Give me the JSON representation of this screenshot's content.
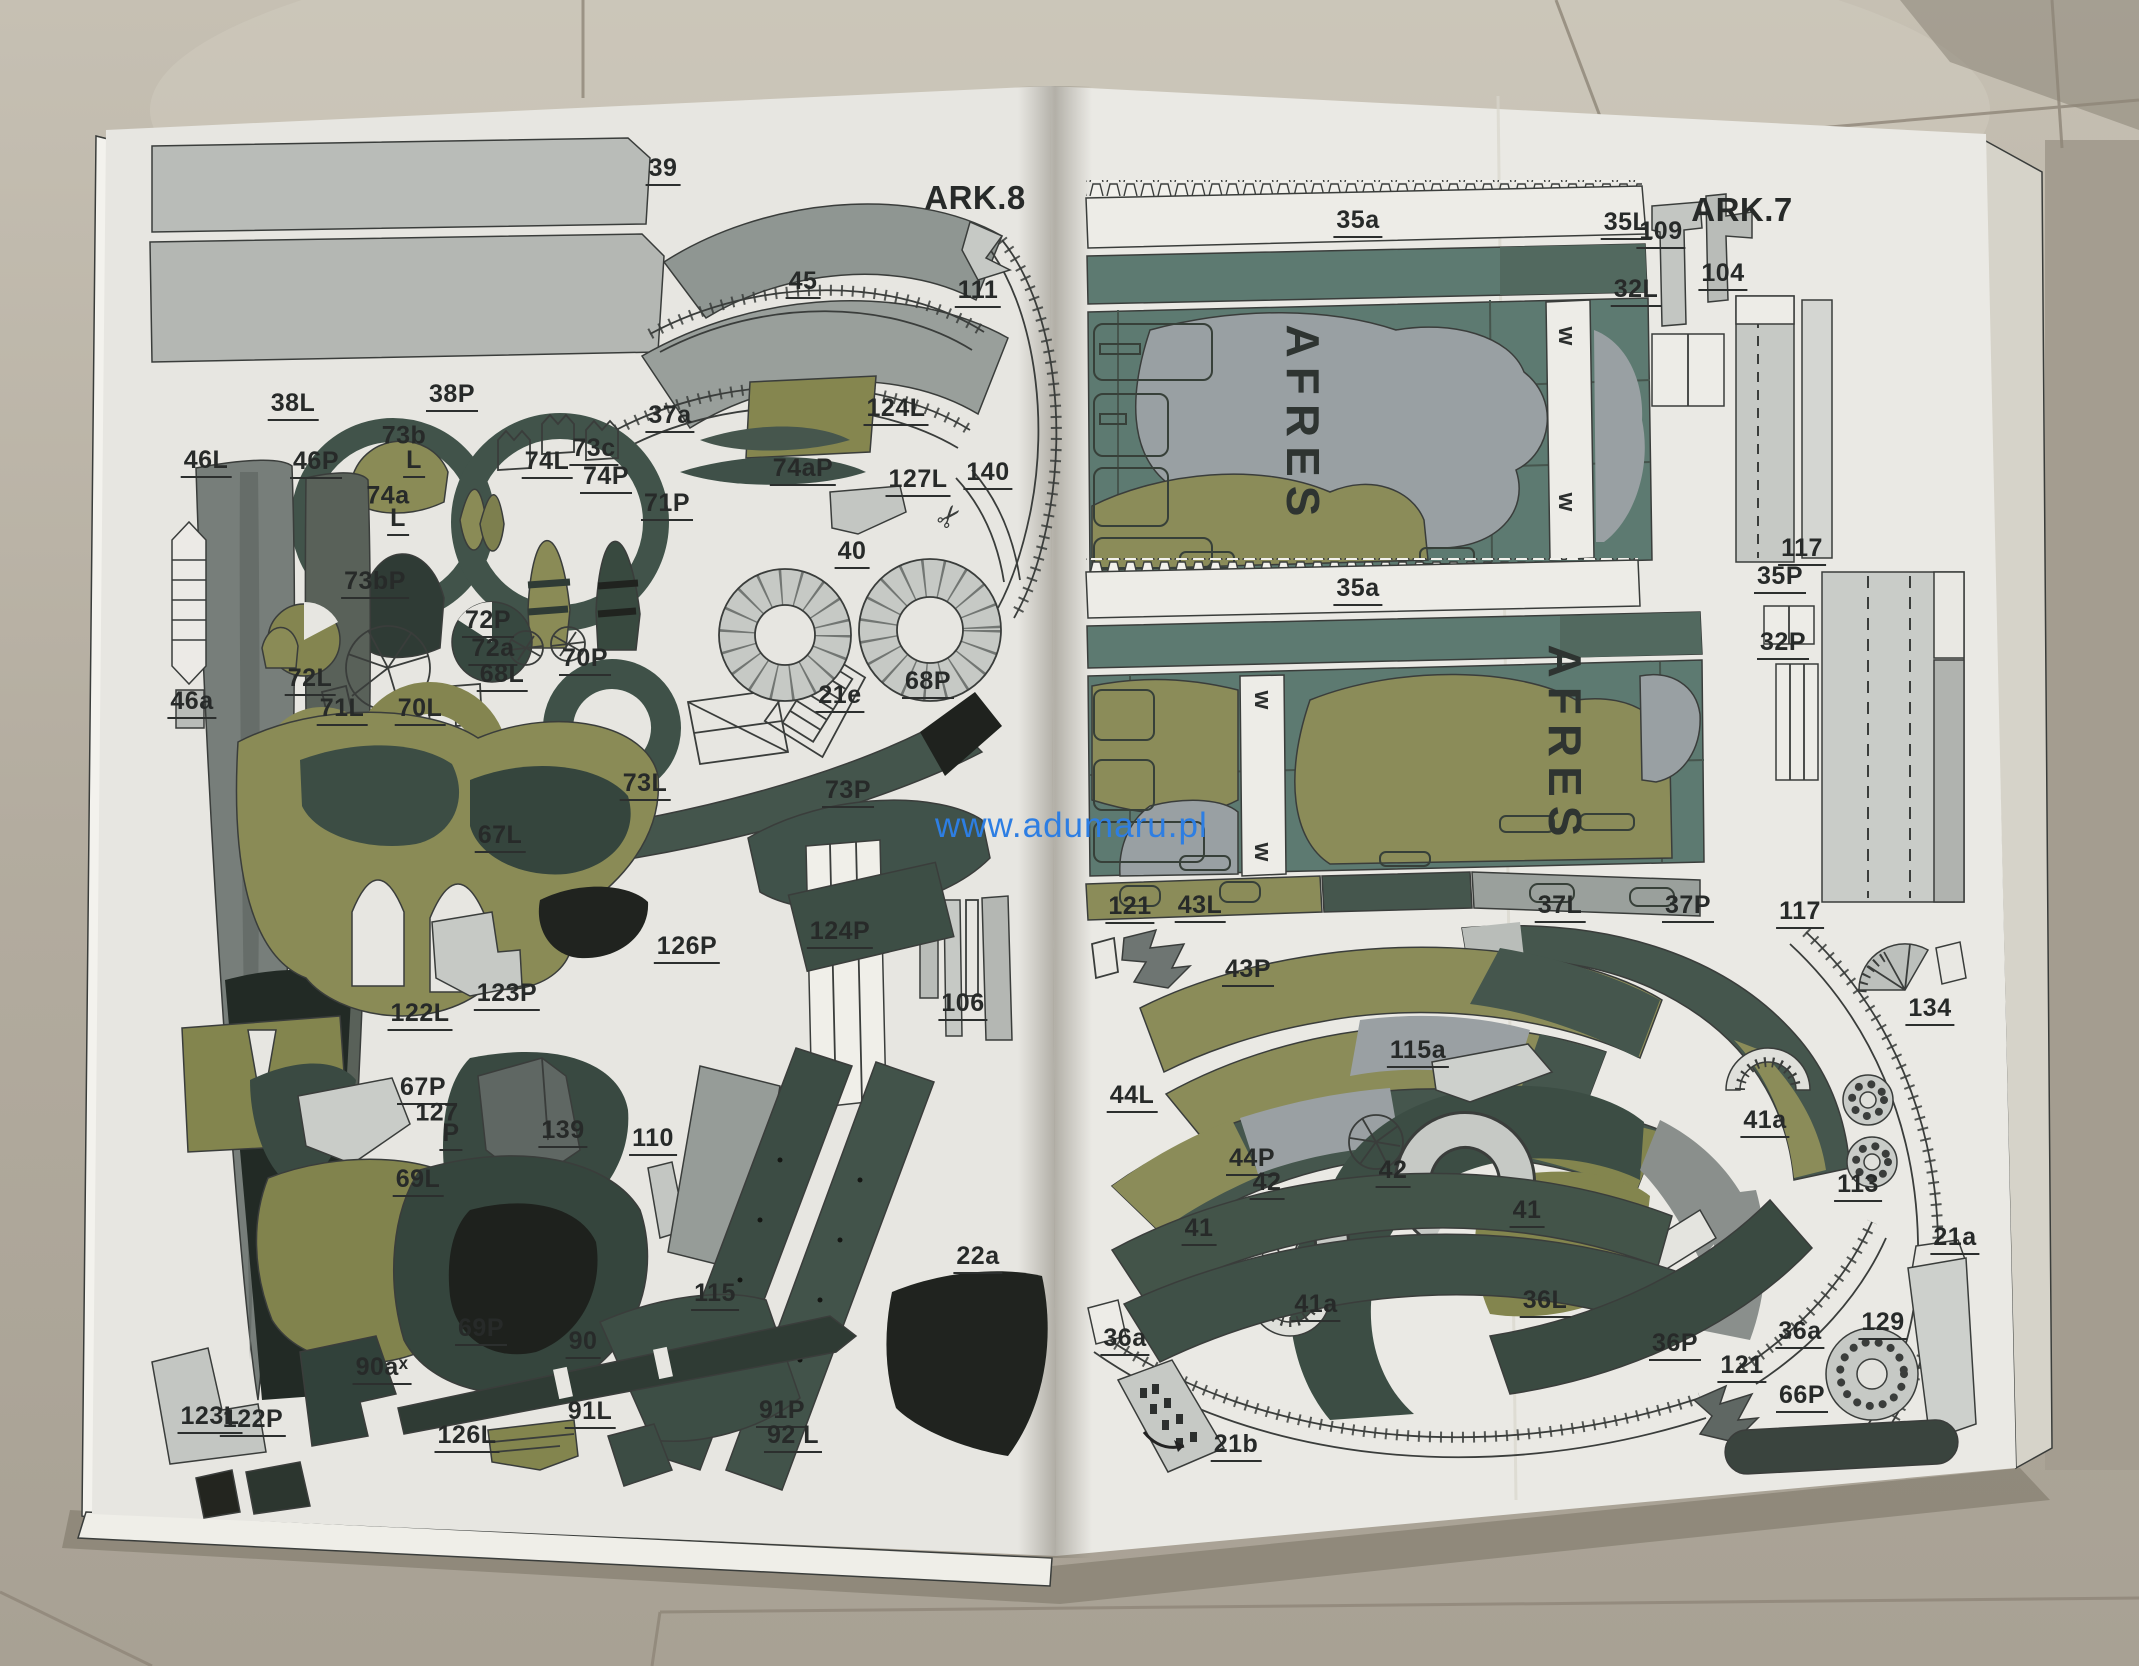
{
  "watermark": "www.adumaru.pl",
  "sheets": {
    "left": "ARK.8",
    "right": "ARK.7"
  },
  "panel_text": "AFRES",
  "w_marker": "w",
  "icons": {
    "scissors": "✂"
  },
  "left_labels": {
    "n39": "39",
    "n45": "45",
    "n111": "111",
    "n38L": "38L",
    "n38P": "38P",
    "n46L": "46L",
    "n46P": "46P",
    "n73b": "73b",
    "n73b_l": "L",
    "n74L": "74L",
    "n73c": "73c",
    "n74P": "74P",
    "n74a": "74a",
    "n74a_l": "L",
    "n73bP": "73bP",
    "n37a": "37a",
    "n74aP": "74aP",
    "n124L": "124L",
    "n127L": "127L",
    "n140": "140",
    "n71P": "71P",
    "n40": "40",
    "n72P": "72P",
    "n72a": "72a",
    "n70P": "70P",
    "n68L": "68L",
    "n21e": "21e",
    "n68P": "68P",
    "n72L": "72L",
    "n71L": "71L",
    "n70L": "70L",
    "n46a": "46a",
    "n73L": "73L",
    "n73P": "73P",
    "n67L": "67L",
    "n124P": "124P",
    "n126P": "126P",
    "n106": "106",
    "n122L": "122L",
    "n123P": "123P",
    "n67P": "67P",
    "n127": "127",
    "n127_p": "P",
    "n139": "139",
    "n110": "110",
    "n69L": "69L",
    "n115": "115",
    "n22a": "22a",
    "n69P": "69P",
    "n90": "90",
    "n90a": "90aˣ",
    "n123L": "123L",
    "n122P": "122P",
    "n126L": "126L",
    "n91L": "91L",
    "n91P": "91P",
    "n92L": "92 L"
  },
  "right_labels": {
    "n35a_1": "35a",
    "n35L": "35L",
    "n109": "109",
    "n32L": "32L",
    "n104": "104",
    "n117_1": "117",
    "n35P": "35P",
    "n32P": "32P",
    "n35a_2": "35a",
    "n121_1": "121",
    "n43L": "43L",
    "n37L": "37L",
    "n37P": "37P",
    "n117_2": "117",
    "n43P": "43P",
    "n134": "134",
    "n115a": "115a",
    "n44L": "44L",
    "n41a_1": "41a",
    "n113": "113",
    "n44P": "44P",
    "n42_1": "42",
    "n42_2": "42",
    "n41_1": "41",
    "n41_2": "41",
    "n41a_2": "41a",
    "n36L": "36L",
    "n21a": "21a",
    "n36a_1": "36a",
    "n36P": "36P",
    "n121_2": "121",
    "n36a_2": "36a",
    "n129": "129",
    "n66P": "66P",
    "n21b": "21b"
  }
}
